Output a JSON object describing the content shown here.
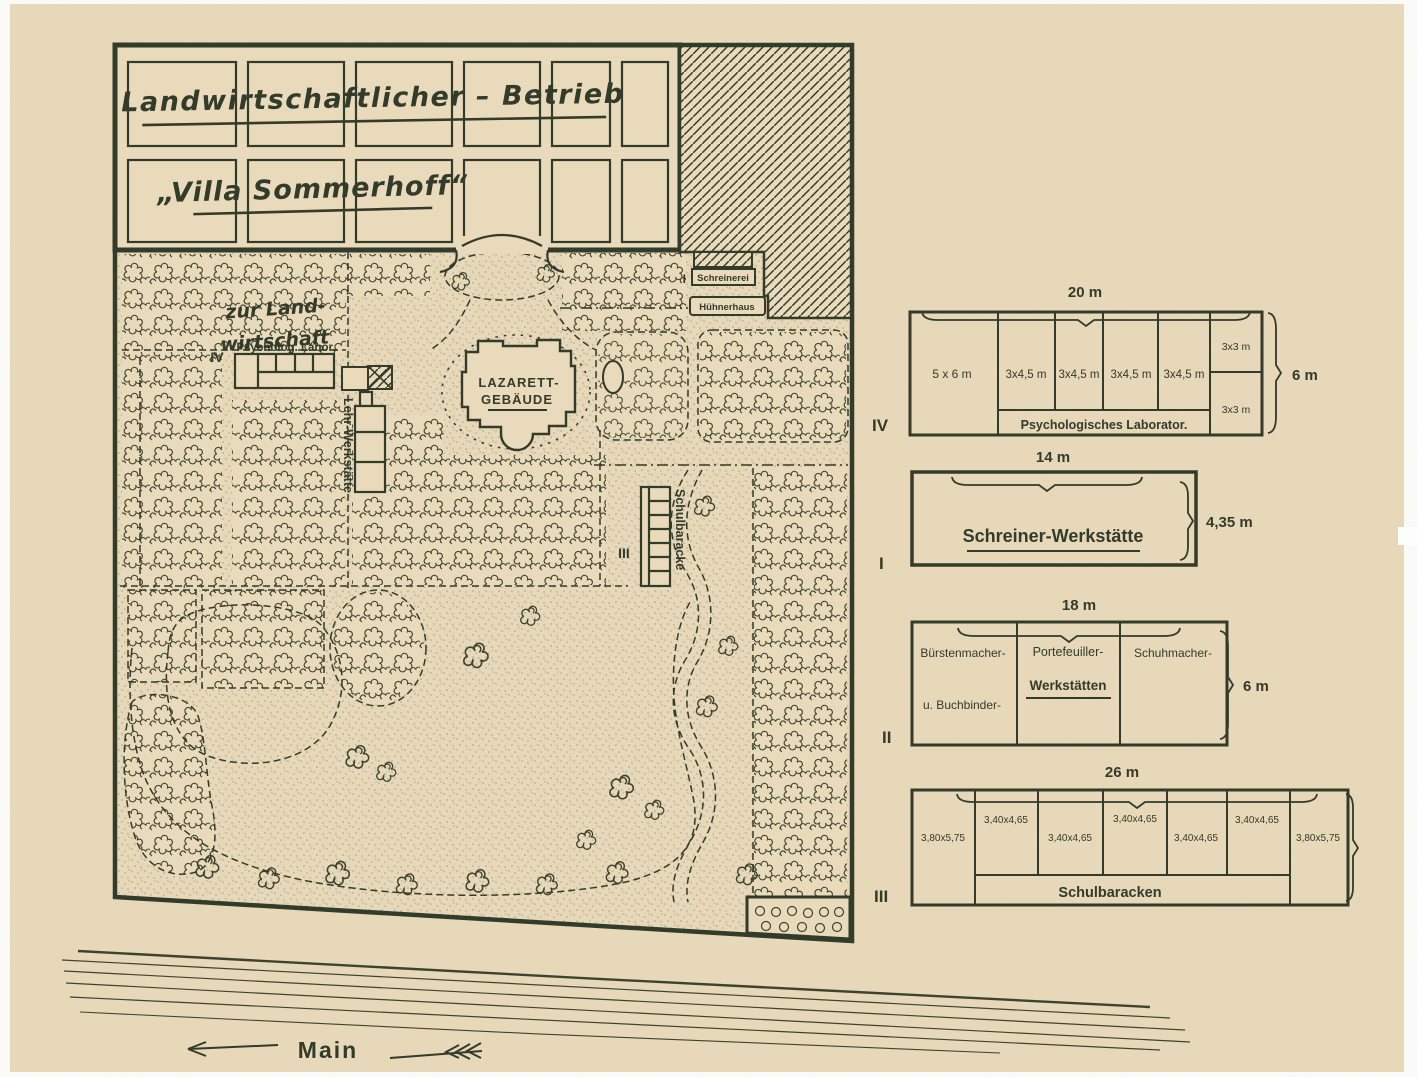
{
  "colors": {
    "ink": "#333b2a",
    "paper": "#e9dabb"
  },
  "map": {
    "farm_field_title": "Landwirtschaftlicher – Betrieb",
    "villa_title": "„Villa Sommerhoff“",
    "garden_note_line1": "zur Land-",
    "garden_note_line2": "wirtschaft",
    "marker_iv": "IV",
    "psych_lab_label": "Psycholog. Labor.",
    "lehr_werkstaette_label": "Lehr-Werkstätte",
    "lazarett_line1": "LAZARETT-",
    "lazarett_line2": "GEBÄUDE",
    "marker_i": "I",
    "schreinerei_label": "Schreinerei",
    "huehnerhaus_label": "Hühnerhaus",
    "marker_iii": "III",
    "schulbaracke_label": "Schulbaracke"
  },
  "plans": {
    "iv": {
      "marker": "IV",
      "width_label": "20 m",
      "height_label": "6 m",
      "cells": [
        "5 x 6 m",
        "3x4,5 m",
        "3x4,5 m",
        "3x4,5 m",
        "3x4,5 m"
      ],
      "small_cells": [
        "3x3 m",
        "3x3 m"
      ],
      "name": "Psychologisches Laborator."
    },
    "i": {
      "marker": "I",
      "width_label": "14 m",
      "height_label": "4,35 m",
      "name": "Schreiner-Werkstätte"
    },
    "ii": {
      "marker": "II",
      "width_label": "18 m",
      "height_label": "6 m",
      "cell1_line1": "Bürstenmacher-",
      "cell1_line2": "u. Buchbinder-",
      "cell2_line1": "Portefeuiller-",
      "cell2_line2": "Werkstätten",
      "cell3": "Schuhmacher-"
    },
    "iii": {
      "marker": "III",
      "width_label": "26 m",
      "end_cell_left": "3,80x5,75",
      "mid_cells": [
        "3,40x4,65",
        "3,40x4,65",
        "3,40x4,65",
        "3,40x4,65",
        "3,40x4,65"
      ],
      "end_cell_right": "3,80x5,75",
      "name": "Schulbaracken"
    }
  },
  "river": {
    "name": "Main"
  }
}
